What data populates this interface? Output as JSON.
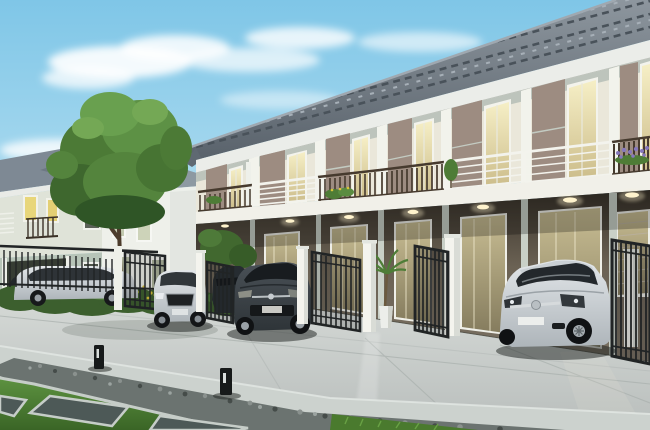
{
  "scene": {
    "type": "architectural-render",
    "description": "3D rendering of a modern two-storey townhouse row with balconies and carports, open black metal gates with white pillars, parked cars, a paved street, gravel strip, lawn with stone pavers and bollard lights, a detached house and a large tree at left, under a blue sky with clouds",
    "objects": [
      "sky",
      "clouds",
      "detached-house",
      "white-house",
      "large-tree",
      "townhouse-row",
      "tiled-roof",
      "fascia",
      "balcony-slab",
      "dark-balcony-railings",
      "white-balcony-railings",
      "upper-windows",
      "carport-glass-doors",
      "ceiling-downlights",
      "support-columns",
      "gate-pillars",
      "open-metal-gates",
      "perimeter-fence",
      "hedge",
      "yellow-flowers",
      "silver-suv",
      "dark-hatchback",
      "dark-parked-car",
      "silver-coupe",
      "estate-car-behind-fence",
      "street-pavement",
      "concrete-apron",
      "gravel-strip",
      "lawn",
      "stone-pavers",
      "bollard-lights",
      "potted-palm",
      "balcony-planters",
      "lavender-planter"
    ]
  },
  "palette": {
    "sky_top": "#7fc6e7",
    "sky_horizon": "#eaf6fb",
    "cloud": "#ffffff",
    "roof_base": "#6e7881",
    "roof_dark": "#49525a",
    "roof_light": "#a7b0b8",
    "fascia": "#ebede9",
    "trim_sage": "#b2bcb4",
    "wall_cream": "#eae7da",
    "wall_taupe": "#9d8c81",
    "pier_white": "#f2f3ec",
    "slab_white": "#f1f0e9",
    "railing_dark": "#463a2e",
    "railing_white": "#f3f3ed",
    "ground_olive": "#6b6254",
    "ground_brown": "#473d30",
    "glass_top": "#f6efc6",
    "glass_bottom": "#cdbe8c",
    "door_glass": "#b3a87f",
    "downlight": "#fff3cd",
    "street": "#c6cac8",
    "street_far": "#d6dad7",
    "apron": "#ccd2ce",
    "gravel": "#6b7370",
    "grass_light": "#5d9240",
    "grass_dark": "#3a6526",
    "hedge": "#3c5f2e",
    "foliage": "#54843d",
    "foliage_light": "#74a855",
    "foliage_dark": "#2f5526",
    "trunk": "#4b3b2b",
    "gate_black": "#212425",
    "pillar_white": "#f4f4ee",
    "car_silver_hi": "#e2e6e9",
    "car_silver_lo": "#aeb5ba",
    "car_dark": "#3d4449",
    "car_navy": "#262c31",
    "left_house_wall": "#dfe3d8",
    "left_house_lower": "#b7c4b8",
    "white_house_wall": "#eef0ea",
    "bg_roof": "#8d99a2",
    "paver_dark": "#4d5957",
    "bollard": "#171a1a",
    "lavender": "#8678bc",
    "flower_yellow": "#d9c33a"
  }
}
